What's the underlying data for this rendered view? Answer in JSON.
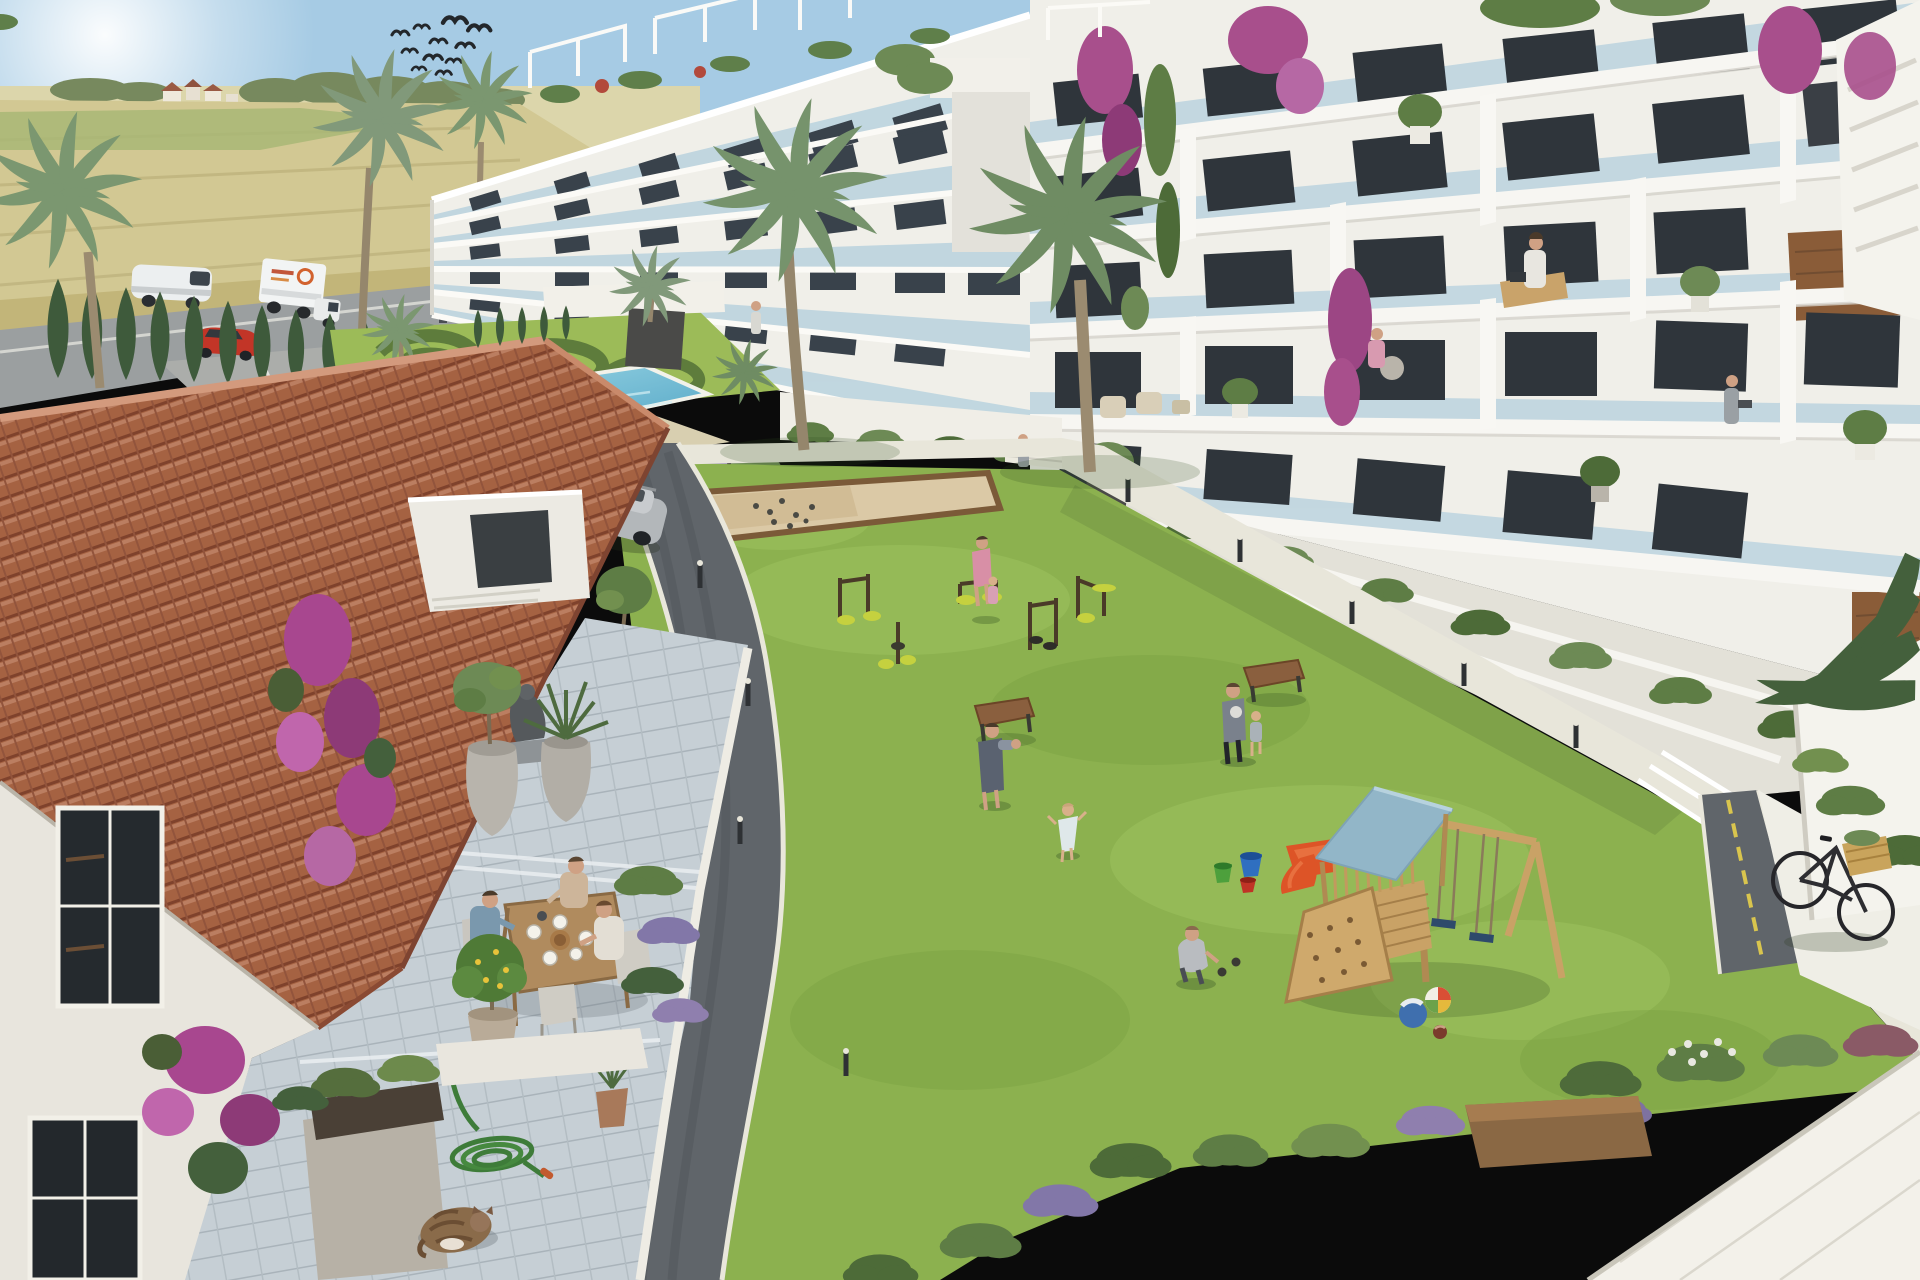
{
  "scene": {
    "kind": "3D architectural rendering",
    "subject": "Aerial view of a modern white apartment complex courtyard with pool, lawn and playground, old tiled-roof house in foreground",
    "weather": "sunny, clear sky"
  },
  "colors": {
    "sky_top": "#a6cbe4",
    "horizon": "#eef3ee",
    "field_gold": "#d2c893",
    "field_green": "#a6b674",
    "treeline": "#77895e",
    "cypress": "#3e5a3b",
    "road_outer": "#9b9fa0",
    "parking": "#abadaa",
    "asphalt": "#60656a",
    "curb": "#e9e7db",
    "grass": "#8cb14f",
    "grass_light": "#9ec45f",
    "path": "#e8e6da",
    "pool_water": "#5fb4d2",
    "pool_deck": "#d8cfb0",
    "building_white": "#f0efe9",
    "glass": "#b9d2de",
    "window_dark": "#39424b",
    "window_warm": "#8a5c38",
    "roof_tile": "#b06a48",
    "roof_tile_light": "#c98a6b",
    "terrace_stone": "#c6cfd5",
    "play_wood": "#c9a266",
    "play_roof": "#92b6c8",
    "slide_red": "#dd5427",
    "gym_seat": "#c5d13f",
    "bougainvillea": "#a84f8c",
    "lavender": "#8277a8",
    "palm_frond": "#7b9770",
    "palm_trunk": "#9b8b70",
    "shrub": "#5e7d45",
    "hose_green": "#3e7c39",
    "cat_fur": "#8a6b4a",
    "suv_silver": "#b3b7ba",
    "car_red": "#c23527",
    "van_white": "#eceff0",
    "sand_court": "#dbc9a6",
    "sand_border": "#7b5a38",
    "bench_wood": "#8a5f3e",
    "bucket_green": "#4da03c",
    "bucket_blue": "#2f6fc0",
    "bucket_red": "#c03326",
    "basket_wicker": "#c9a45c"
  },
  "background": {
    "birds_count": 11,
    "village_houses": 4,
    "hedge_cypress_count": 18,
    "vehicles_outer_road": [
      "white van",
      "white box truck with logo",
      "red car"
    ],
    "field_type": "golden wheat farmland"
  },
  "buildings": {
    "left_block": {
      "floors": 5,
      "features": [
        "rooftop pergolas",
        "glass balconies",
        "roof-edge shrubs",
        "red flower pots"
      ]
    },
    "right_block": {
      "floors": 5,
      "features": [
        "glass balconies",
        "bougainvillea cascades",
        "potted olive trees",
        "bookshelf interiors",
        "external white stair"
      ]
    }
  },
  "amenities": [
    "swimming pool",
    "topiary swirl garden",
    "petanque sand court",
    "outdoor gym (5 stations)",
    "central lawn",
    "children playground",
    "benches"
  ],
  "playground": {
    "items": [
      "wooden tower",
      "light blue gable roof",
      "climbing ramp with holds",
      "A-frame double swing",
      "red toddler slide",
      "beach ball",
      "blue ball",
      "small ball",
      "three buckets"
    ]
  },
  "people": {
    "in_pool": 2,
    "on_lawn": 7,
    "at_gym": 2,
    "terrace_dining": 3,
    "on_balconies": 3,
    "walking": 3
  },
  "foreground_house": {
    "roof": "terracotta barrel tiles",
    "terrace_items": [
      "abstract statue",
      "olive tree urn",
      "yucca urn",
      "wooden dining table",
      "plates and bread basket",
      "lemon tree pot",
      "lavender bushes",
      "stone planter box",
      "coiled green garden hose",
      "sleeping tabby cat",
      "small potted plant"
    ]
  },
  "objects": {
    "suv": "silver SUV on internal road",
    "bicycle": "black city bicycle with wicker basket",
    "benches_on_lawn": 2,
    "bollard_lights": 7
  }
}
